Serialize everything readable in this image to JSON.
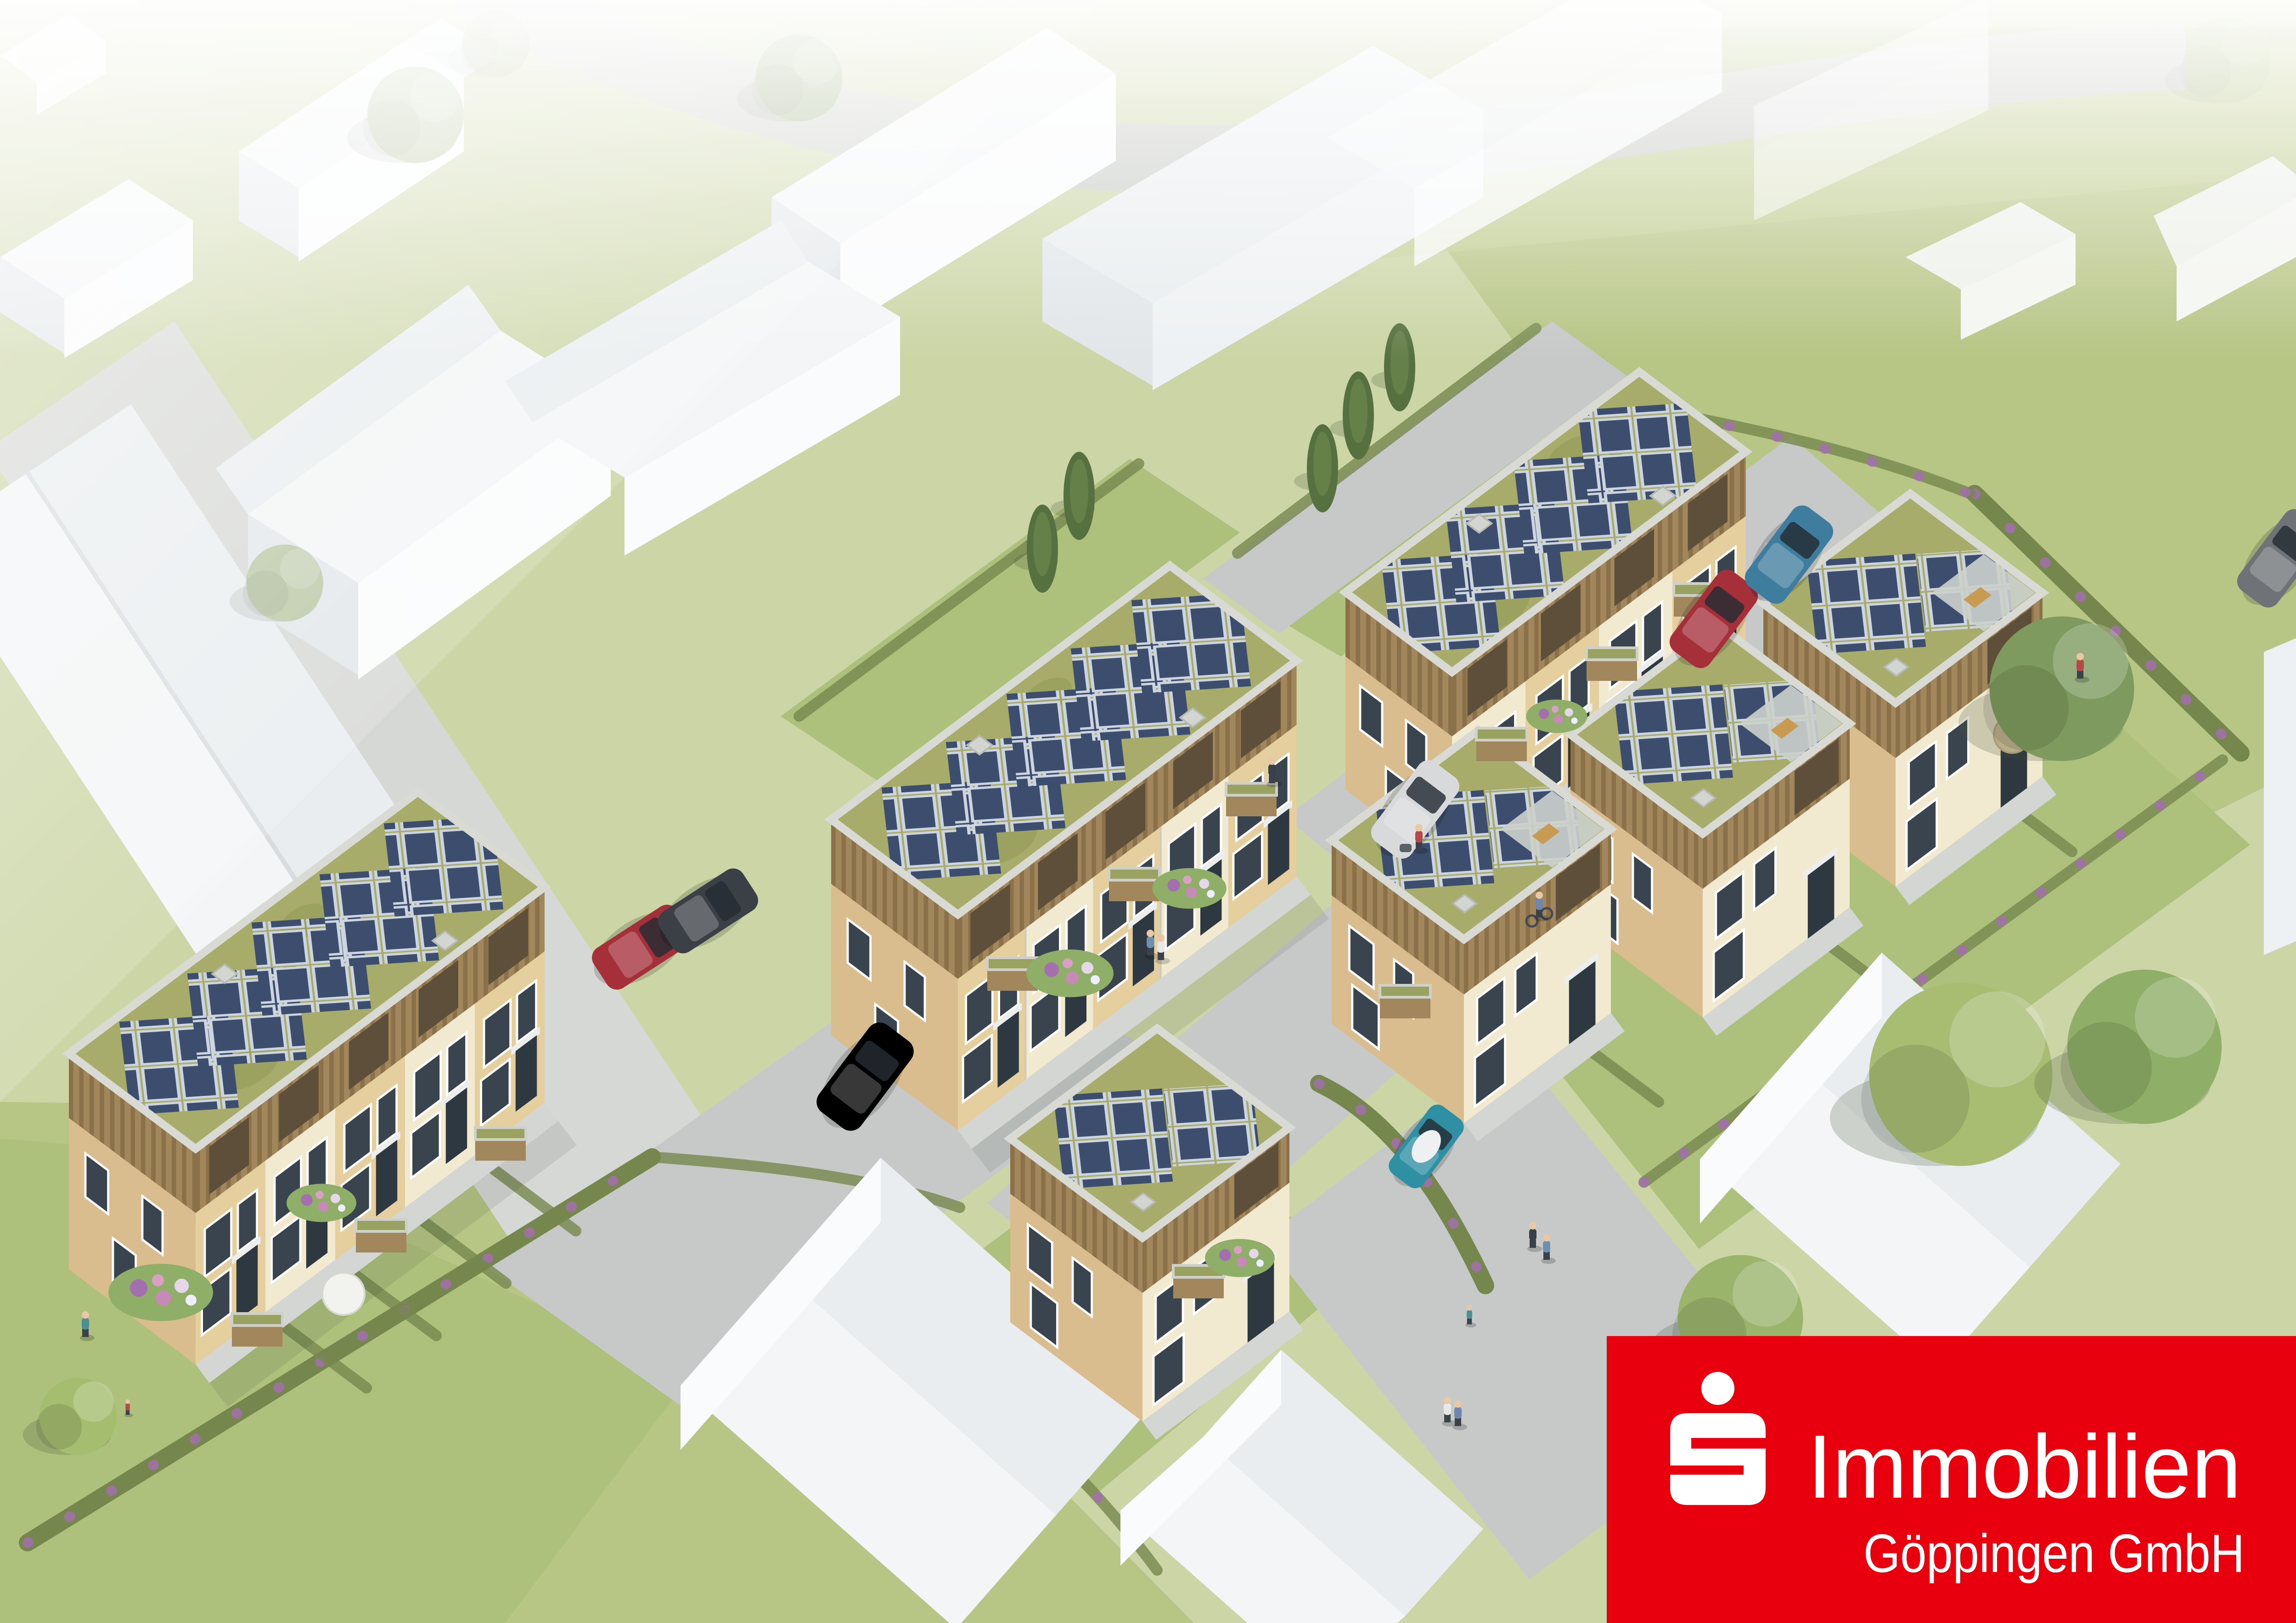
{
  "scene": {
    "type": "aerial-3d-architectural-rendering",
    "description": "Aerial visualization of a new residential quarter: beige new-build houses with wood-clad upper floors, green sedum flat roofs and dark blue photovoltaic panels, surrounded by schematic white neighbouring buildings, grey streets with parked cars, lawns, flowering hedges and trees.",
    "new_solar_buildings": 7,
    "terraced_rows": 3,
    "detached_houses": 4,
    "parked_cars": 7
  },
  "logo": {
    "icon": "sparkasse-s-icon",
    "line1": "Immobilien",
    "line2": "Göppingen GmbH"
  },
  "palette": {
    "brand_red": "#e9000e",
    "logo_white": "#ffffff",
    "grass_base": "#cbd5a5",
    "meadow": "#b7c585",
    "meadow2": "#c3ce93",
    "lawn": "#adc07c",
    "road": "#c6c9c8",
    "road_pale": "#d6d8d5",
    "pavement_light": "#d4d6d3",
    "wall_cream": "#f2ead0",
    "wall_beige": "#e6cf9e",
    "wall_tan": "#d9bd8e",
    "wood": "#a2875c",
    "wood_dark": "#8b7149",
    "recess": "#5d4f39",
    "door": "#2e3840",
    "window": "#39444e",
    "roof_green": "#a7ac6b",
    "solar_panel": "#3d4d6e",
    "solar_frame": "#cdd5e0",
    "parapet": "#d9dad4",
    "white_wall": "#fafbfc",
    "white_wall_mid": "#eef1f3",
    "white_wall_shade": "#e2e6e9",
    "white_roof": "#f3f5f6",
    "white_roof_shade": "#e9edef",
    "hedge": "#75874d",
    "hedge_flower": "#a36fae",
    "cypress": "#56713f",
    "car_red": "#a5303a",
    "car_dark": "#3b3f46",
    "car_silver": "#d7d9db",
    "car_blue": "#3f7d9e",
    "car_teal": "#2f8fa3",
    "skin": "#e9c8a6"
  }
}
